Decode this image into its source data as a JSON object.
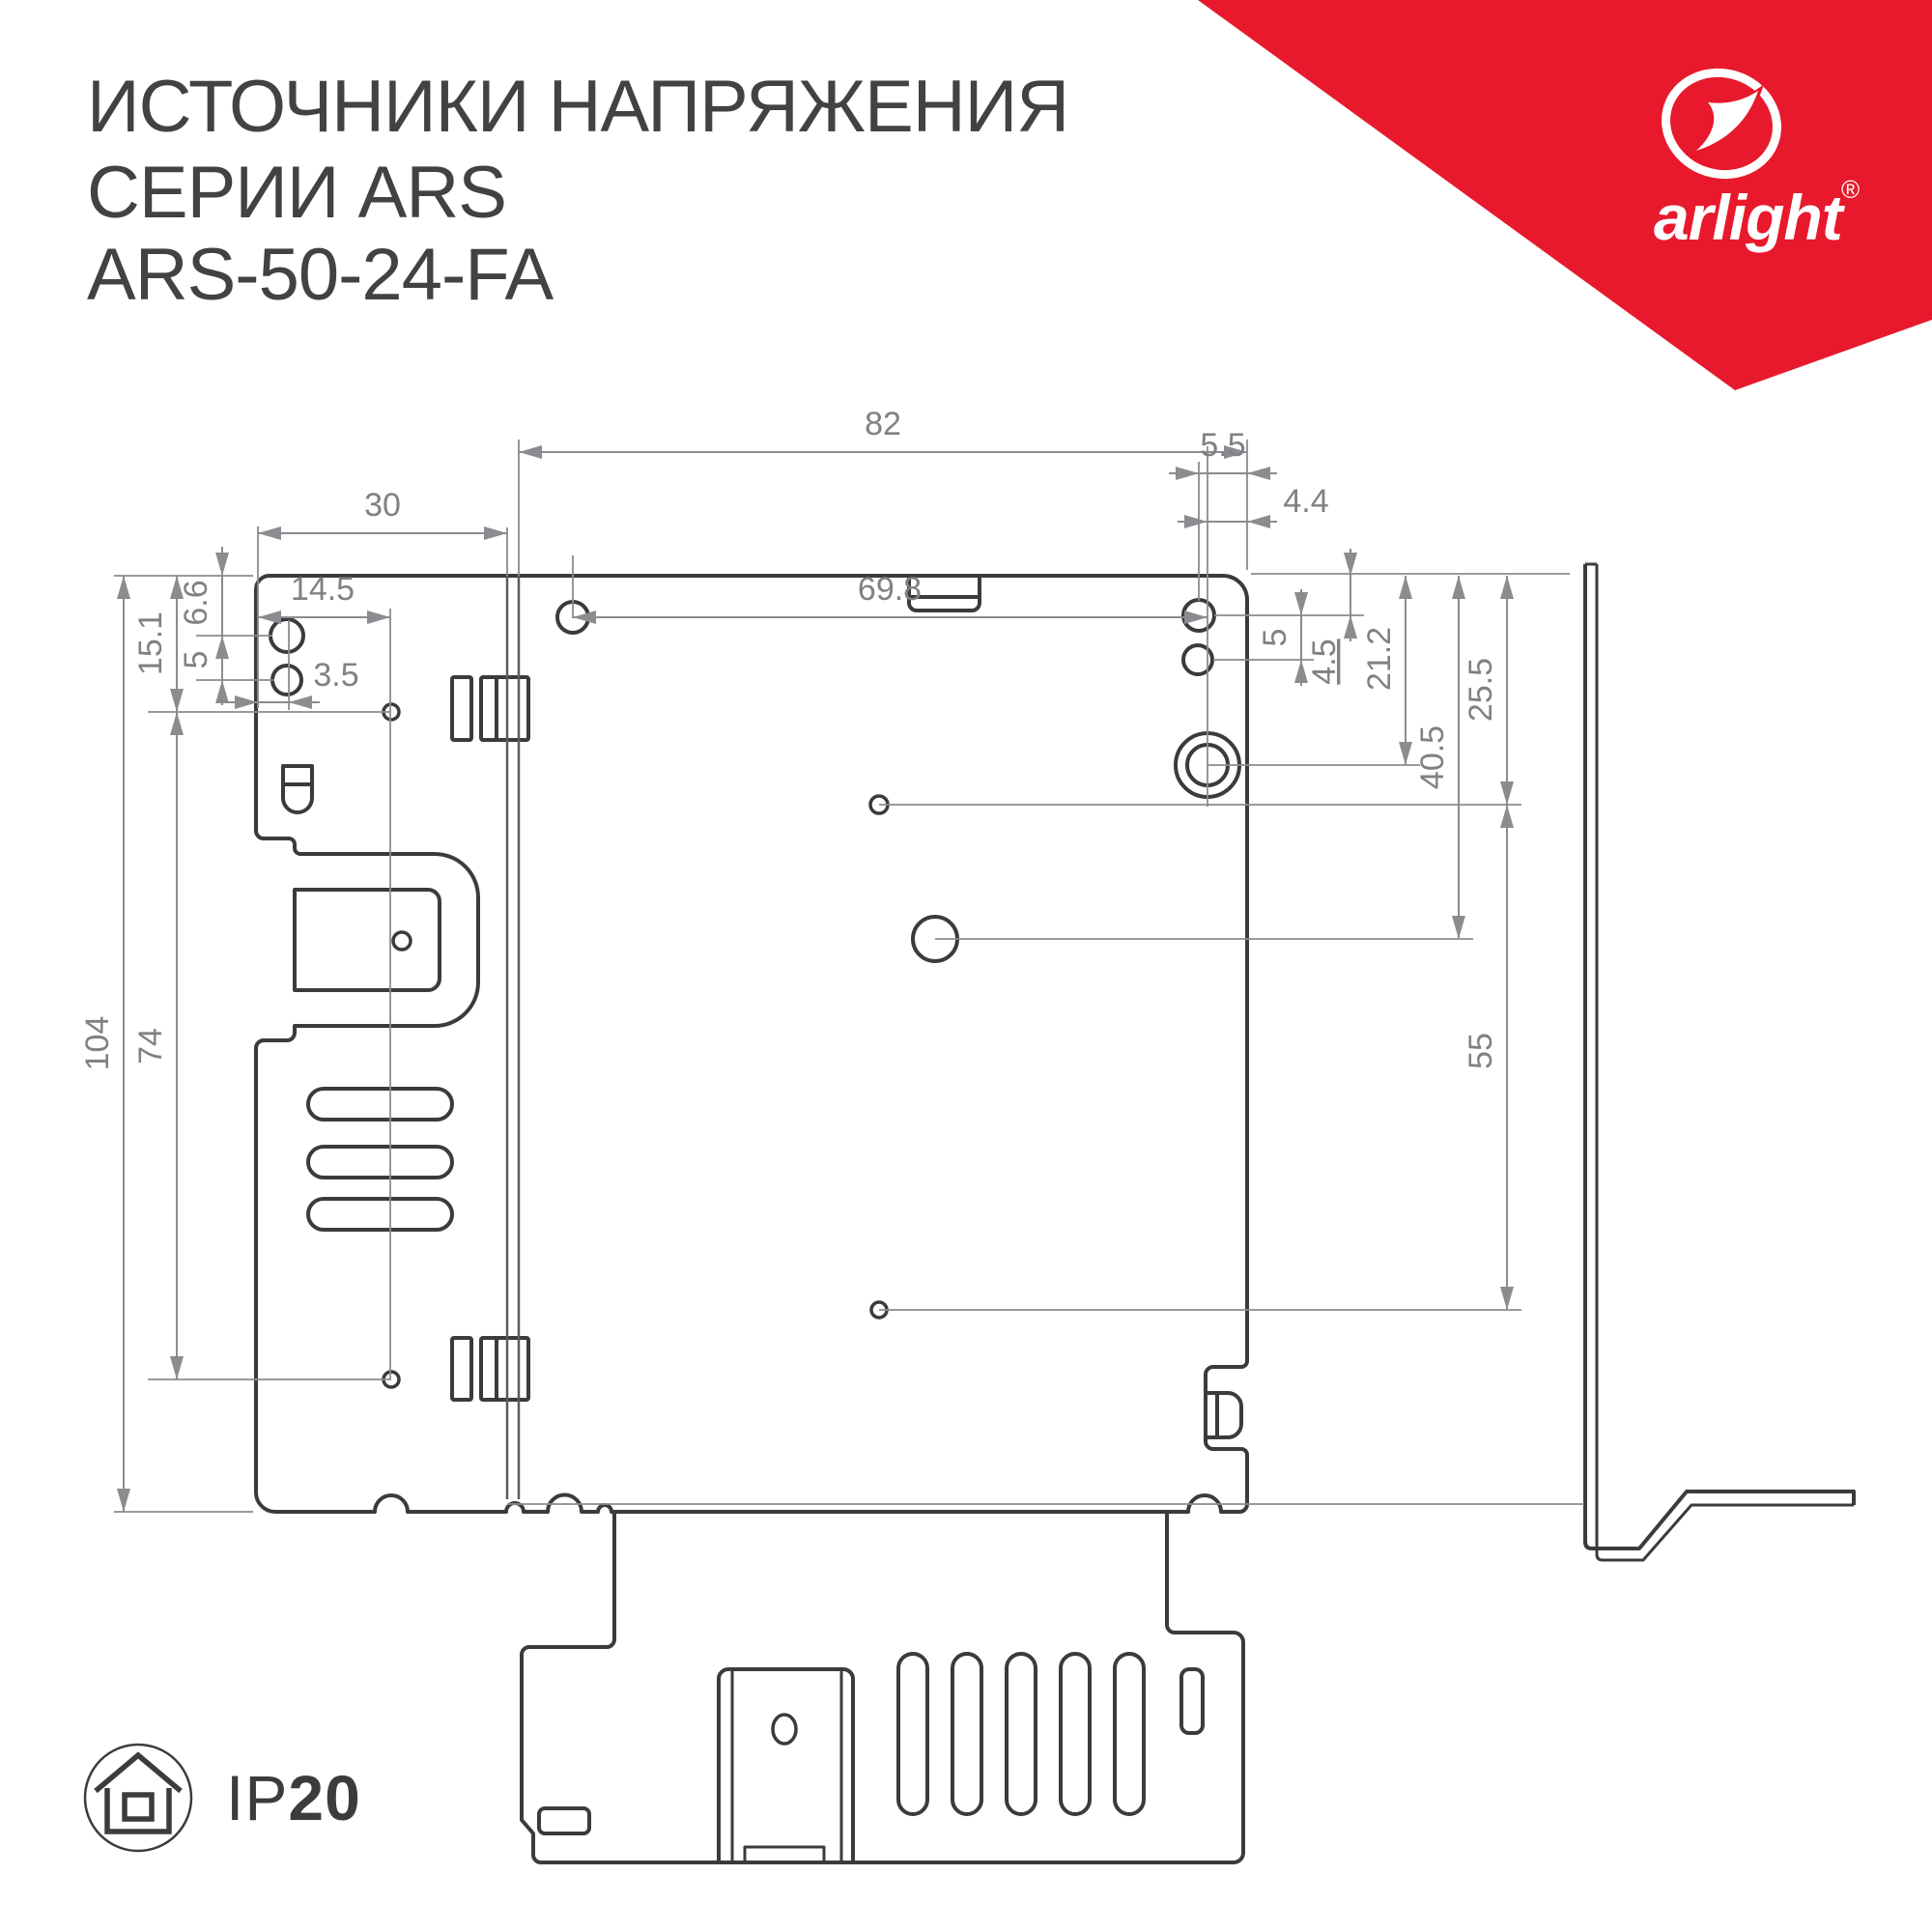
{
  "title": {
    "line1": "ИСТОЧНИКИ НАПРЯЖЕНИЯ",
    "line2": "СЕРИИ ARS",
    "line3": "ARS-50-24-FA"
  },
  "brand": {
    "name": "arlight",
    "registered": "®"
  },
  "ip_badge": {
    "prefix": "IP",
    "rating": "20"
  },
  "colors": {
    "accent_red": "#E8192C",
    "drawing_line": "#3A3B3D",
    "dimension_gray": "#8A8C8F",
    "dimension_text": "#7F8184",
    "title_text": "#414244"
  },
  "dims": {
    "top": {
      "d82": "82",
      "d30": "30",
      "d14_5": "14.5",
      "d3_5": "3.5",
      "d69_8": "69.8",
      "d5_5": "5.5",
      "d4_4": "4.4"
    },
    "left": {
      "d104": "104",
      "d74": "74",
      "d15_1": "15.1",
      "d6_6": "6.6",
      "d5": "5"
    },
    "right": {
      "d5": "5",
      "d4_5": "4.5",
      "d21_2": "21.2",
      "d25_5": "25.5",
      "d40_5": "40.5",
      "d55": "55"
    }
  }
}
